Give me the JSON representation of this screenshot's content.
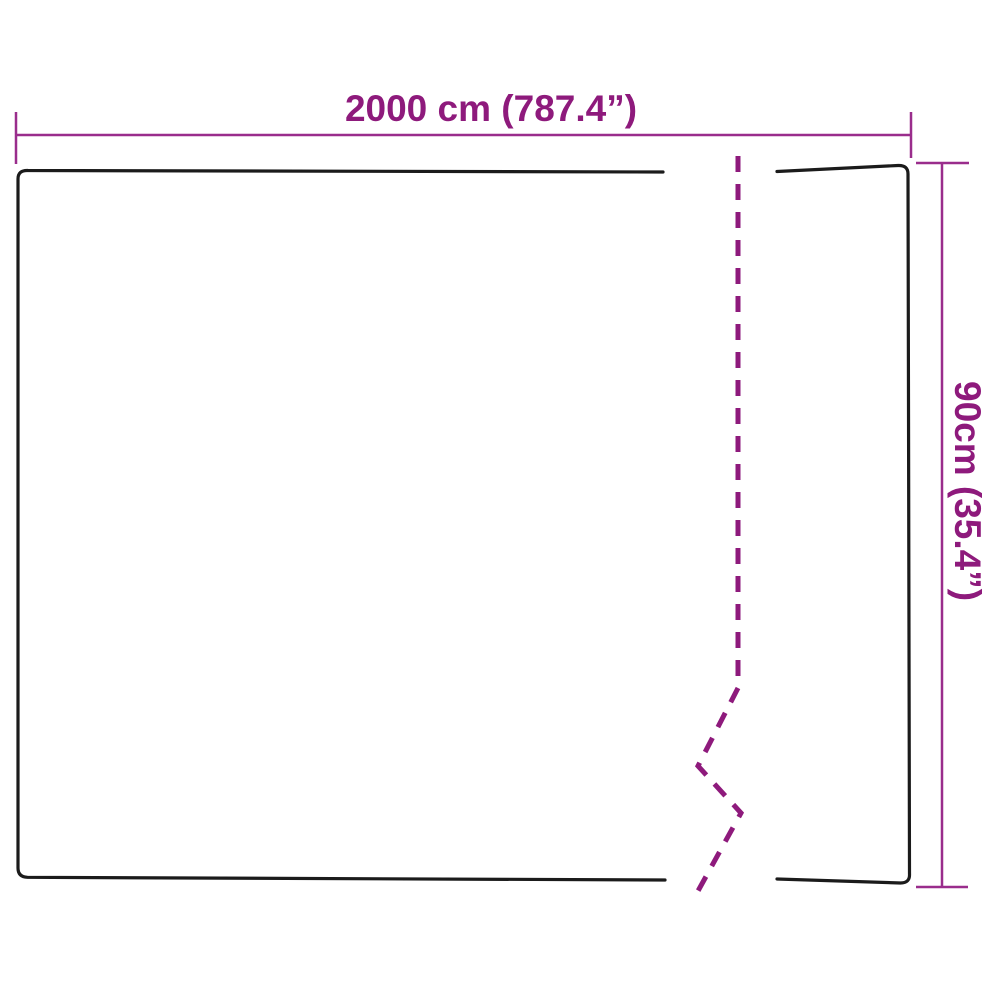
{
  "diagram": {
    "type": "product-dimension-diagram",
    "subject": "flat rectangular sheet drawn in outline with a dashed break line indicating shortened length",
    "width": {
      "label": "2000 cm (787.4”)",
      "value_cm": 2000,
      "value_inch": 787.4
    },
    "height": {
      "label": "90cm (35.4”)",
      "value_cm": 90,
      "value_inch": 35.4
    }
  },
  "colors": {
    "dimension_accent": "#8E1A7C",
    "dimension_line": "#9A2D8C",
    "outline": "#1B1B1B",
    "background": "#FFFFFF"
  }
}
